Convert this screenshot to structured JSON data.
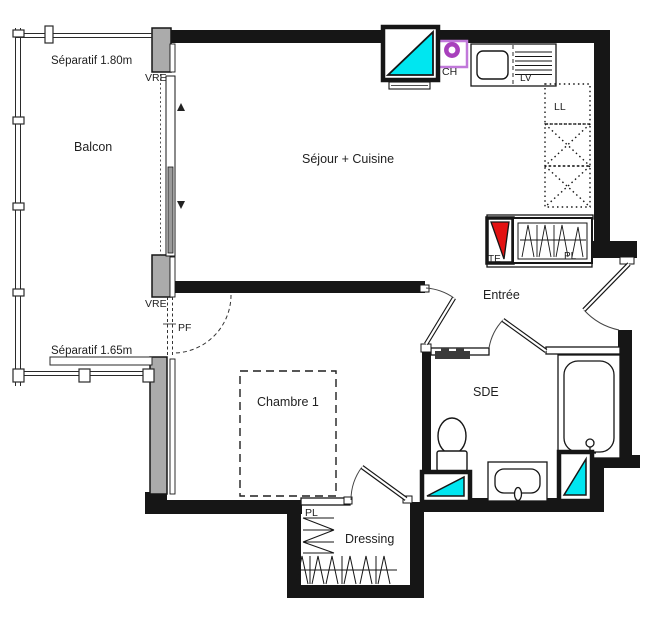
{
  "title": "Plan appartement T2",
  "rooms": {
    "balcon": "Balcon",
    "sejour_cuisine": "Séjour + Cuisine",
    "chambre": "Chambre 1",
    "entree": "Entrée",
    "sde": "SDE",
    "dressing": "Dressing"
  },
  "annotations": {
    "separatif_haut": "Séparatif 1.80m",
    "separatif_bas": "Séparatif 1.65m",
    "vre_haut": "VRE",
    "vre_milieu": "VRE",
    "pf": "PF",
    "ch": "CH",
    "lv": "LV",
    "ll": "LL",
    "te": "TE",
    "pl_entree": "PL",
    "pl_dressing": "PL"
  },
  "colors": {
    "wall": "#161616",
    "concrete": "#ababab",
    "duct_cyan": "#00e6f0",
    "electric_red": "#e31212",
    "boiler_purple_frame": "#c178da",
    "boiler_purple_ring": "#a840bc",
    "line": "#1f1f1f"
  }
}
